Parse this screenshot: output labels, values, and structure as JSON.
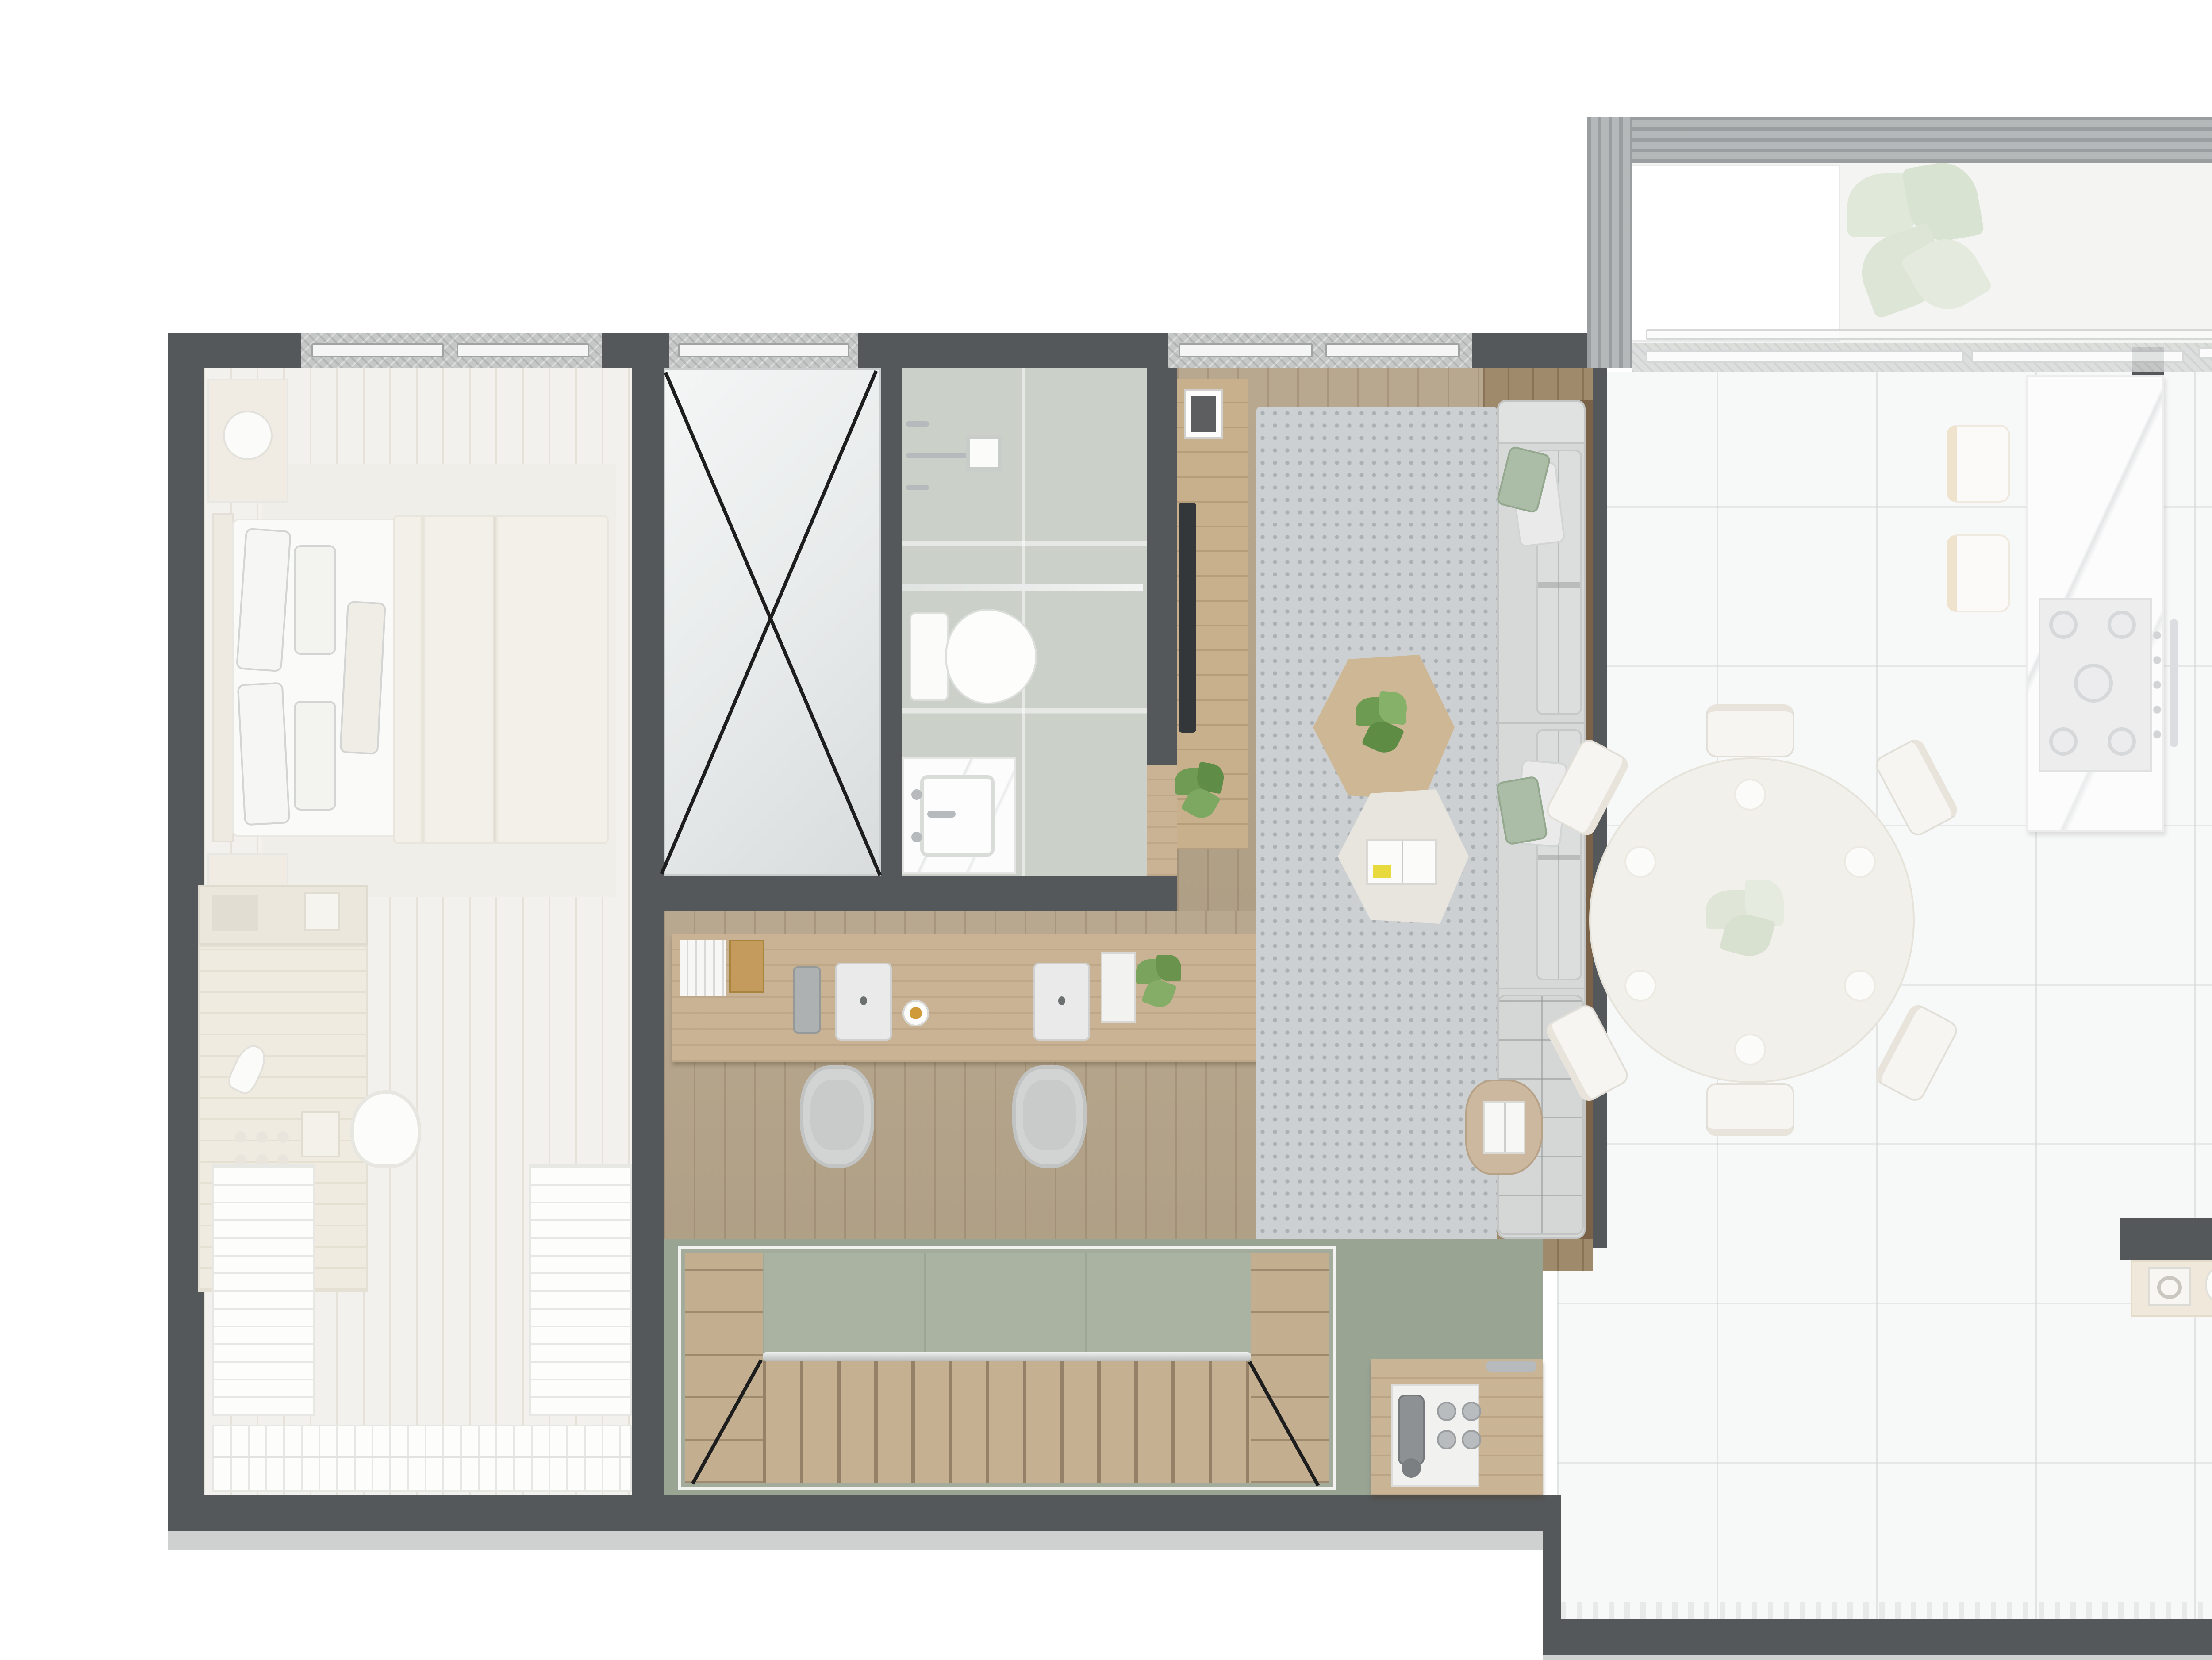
{
  "meta": {
    "type": "architectural-floor-plan",
    "view": "top-down-render",
    "visible_text": "none",
    "style": "photorealistic furnished plan, active zone in color, adjacent zones faded white"
  },
  "palette": {
    "wall": "#54585a",
    "wood_floor": "#b2a186",
    "desk_wood": "#c9b394",
    "stair_sage": "#9aa493",
    "stair_treads": "#c5b092",
    "bathroom_tile": "#cbd1c8",
    "rug_gray": "#ccd0d2",
    "sofa_gray": "#d7d9d8",
    "pillow_sage": "#abbda7",
    "faded_floor": "#f5f4f1",
    "kitchen_floor": "#f7f8f8",
    "granite_sill": "#c6c8c7",
    "concrete_band": "#b5b8b9",
    "shaft_hatch": "#eadfc9",
    "plant_green": "#6f9b55",
    "shadow": "#c7c9c9"
  },
  "rooms": {
    "bedroom": {
      "name": "bedroom (faded)",
      "items": [
        "double bed with duvet and pillows",
        "nightstand with lamp x2",
        "area rug",
        "vanity desk with hair dryer and cosmetics",
        "vanity chair",
        "wardrobe shelving left",
        "wardrobe shelving right",
        "wardrobe shelving bottom",
        "window"
      ]
    },
    "shaft": {
      "name": "void shaft marked with X",
      "items": [
        "X cross lines",
        "window"
      ]
    },
    "bathroom": {
      "name": "bathroom",
      "items": [
        "shower head and mixer",
        "glass partition",
        "toilet",
        "marble vanity with basin",
        "door opening"
      ]
    },
    "study": {
      "name": "study / tv lounge",
      "items": [
        "double workstation desk",
        "two laptops",
        "desk speaker",
        "coffee cup",
        "book stack",
        "magazines",
        "desk plant",
        "two desk chairs",
        "recessed book niche",
        "tv sideboard",
        "tv",
        "framed portrait",
        "floor plant"
      ]
    },
    "living": {
      "name": "living room",
      "items": [
        "gray rug",
        "three seat modular sofa",
        "white quilted pillows",
        "sage pillows",
        "tufted ottoman",
        "hexagonal wood coffee table with plant",
        "hexagonal white coffee table with open magazine",
        "side table with book",
        "window"
      ]
    },
    "stairs": {
      "name": "staircase down",
      "items": [
        "upper landing",
        "wood treads",
        "winder diagonals",
        "side shelf columns",
        "glass rail"
      ]
    },
    "hall_sideboard": {
      "name": "hall sideboard",
      "items": [
        "serving tray",
        "coffee machine",
        "four cups"
      ]
    },
    "dining": {
      "name": "dining (faded)",
      "items": [
        "round table for six",
        "six chairs",
        "flower centerpiece",
        "place settings"
      ]
    },
    "kitchen": {
      "name": "kitchen (faded)",
      "items": [
        "marble island",
        "five burner cooktop",
        "oven handle",
        "two bar stools",
        "tall counter",
        "sink with drainboard",
        "dish basket",
        "double sink",
        "four burner tray",
        "half wall with decor shelf",
        "glass wall to rear"
      ]
    },
    "terrace": {
      "name": "terrace (faded)",
      "items": [
        "concrete parapet",
        "skylight opening",
        "large plant",
        "sliding glass door",
        "technical shaft hatch"
      ]
    }
  }
}
